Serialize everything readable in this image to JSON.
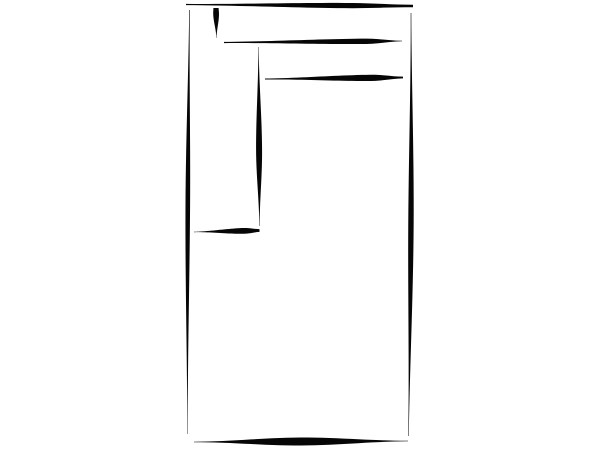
{
  "canvas": {
    "width": 600,
    "height": 450,
    "background_color": "#ffffff",
    "ink_color": "#060606"
  },
  "sketch": {
    "subject": "hand-drawn-rectangle-outline-sketch",
    "strokes": [
      {
        "name": "top-edge",
        "x1": 186,
        "y1": 4.5,
        "x2": 413,
        "y2": 6,
        "w0": 1.2,
        "wMax": 5.2,
        "p": 0.72,
        "w1": 2.5,
        "bow": 0
      },
      {
        "name": "left-edge",
        "x1": 189.5,
        "y1": 10,
        "x2": 187.5,
        "y2": 434,
        "w0": 0.6,
        "wMax": 4.6,
        "p": 0.45,
        "w1": 0.4,
        "bow": 0.8
      },
      {
        "name": "right-edge",
        "x1": 411,
        "y1": 13,
        "x2": 408.5,
        "y2": 436,
        "w0": 0.6,
        "wMax": 5.4,
        "p": 0.5,
        "w1": 0.5,
        "bow": -1.2
      },
      {
        "name": "bottom-edge",
        "x1": 194,
        "y1": 442,
        "x2": 408,
        "y2": 441,
        "w0": 0.5,
        "wMax": 8,
        "p": 0.5,
        "w1": 0.6,
        "bow": 0
      },
      {
        "name": "top-left-tick",
        "x1": 216,
        "y1": 8,
        "x2": 216.5,
        "y2": 38,
        "w0": 5.2,
        "wMax": 5.8,
        "p": 0.18,
        "w1": 0.3,
        "bow": 0
      },
      {
        "name": "upper-divider",
        "x1": 224,
        "y1": 42.5,
        "x2": 402,
        "y2": 41,
        "w0": 1.2,
        "wMax": 5.4,
        "p": 0.8,
        "w1": 0.6,
        "bow": 0
      },
      {
        "name": "inner-vertical",
        "x1": 258.5,
        "y1": 47,
        "x2": 259.5,
        "y2": 226,
        "w0": 0.4,
        "wMax": 6,
        "p": 0.58,
        "w1": 0.4,
        "bow": 0
      },
      {
        "name": "mid-divider",
        "x1": 265,
        "y1": 79,
        "x2": 403,
        "y2": 77.5,
        "w0": 1.0,
        "wMax": 6.2,
        "p": 0.78,
        "w1": 1.8,
        "bow": 0
      },
      {
        "name": "left-shelf-line",
        "x1": 194,
        "y1": 232,
        "x2": 259.5,
        "y2": 230.5,
        "w0": 0.4,
        "wMax": 5.8,
        "p": 0.78,
        "w1": 2.8,
        "bow": 0
      }
    ]
  }
}
